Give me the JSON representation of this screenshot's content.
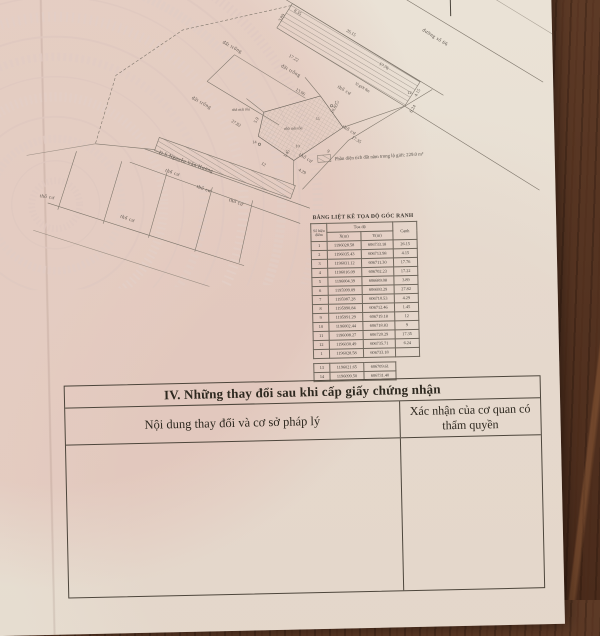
{
  "document": {
    "map": {
      "legend_text": "Phần diện tích đất nằm trong lộ giới: 229.0 m²",
      "labels": {
        "road_top": "đường số 66",
        "road_boundary": "lộ giới 8m",
        "road_bottom": "Đ.S Nguyễn Văn Hưởng",
        "vacant1": "đất trống",
        "vacant2": "đất trống",
        "vacant3": "đất trống",
        "res1": "thổ cư",
        "res2": "thổ cư",
        "res3": "thổ cư",
        "res4": "thổ cư",
        "res5": "thổ cư",
        "res6": "thổ cư",
        "res7": "thổ cư",
        "res8": "thổ cư",
        "house1": "nhà mái tôn",
        "house2": "nhà mái tôn"
      },
      "dimensions": [
        "26.15",
        "4.15",
        "17.76",
        "17.22",
        "3.89",
        "27.82",
        "4.29",
        "1.45",
        "12",
        "9",
        "17.35",
        "6.24",
        "13.06",
        "10.85",
        "5.9",
        "8.35"
      ],
      "points": [
        "11",
        "13",
        "14",
        "10",
        "12"
      ]
    },
    "coord_table": {
      "title": "BẢNG LIỆT KÊ TỌA ĐỘ GÓC RANH",
      "col_point": "Số hiệu điểm",
      "col_coords": "Tọa độ",
      "col_x": "X(m)",
      "col_y": "Y(m)",
      "col_edge": "Cạnh",
      "rows": [
        {
          "n": "1",
          "x": "1196028.58",
          "y": "606733.18",
          "c": "26.15"
        },
        {
          "n": "2",
          "x": "1196035.43",
          "y": "606713.98",
          "c": "4.15"
        },
        {
          "n": "3",
          "x": "1196031.12",
          "y": "606711.30",
          "c": "17.76"
        },
        {
          "n": "4",
          "x": "1196016.09",
          "y": "606702.23",
          "c": "17.22"
        },
        {
          "n": "5",
          "x": "1196004.39",
          "y": "606689.08",
          "c": "3.89"
        },
        {
          "n": "6",
          "x": "1195999.09",
          "y": "606693.29",
          "c": "27.82"
        },
        {
          "n": "7",
          "x": "1195987.28",
          "y": "606710.53",
          "c": "4.29"
        },
        {
          "n": "8",
          "x": "1195990.84",
          "y": "606712.46",
          "c": "1.45"
        },
        {
          "n": "9",
          "x": "1195991.29",
          "y": "606719.18",
          "c": "12"
        },
        {
          "n": "10",
          "x": "1196002.44",
          "y": "606718.83",
          "c": "9"
        },
        {
          "n": "11",
          "x": "1196008.27",
          "y": "606720.29",
          "c": "17.35"
        },
        {
          "n": "12",
          "x": "1196030.49",
          "y": "606735.71",
          "c": "6.24"
        },
        {
          "n": "1",
          "x": "1196028.58",
          "y": "606733.18",
          "c": ""
        }
      ],
      "extra_rows": [
        {
          "n": "13",
          "x": "1196021.65",
          "y": "606709.61"
        },
        {
          "n": "14",
          "x": "1196099.50",
          "y": "606731.40"
        }
      ]
    },
    "section4": {
      "title": "IV. Những thay đổi sau khi cấp giấy chứng nhận",
      "col_content": "Nội dung thay đổi và cơ sở pháp lý",
      "col_confirm": "Xác nhận của cơ quan có thẩm quyền"
    }
  }
}
